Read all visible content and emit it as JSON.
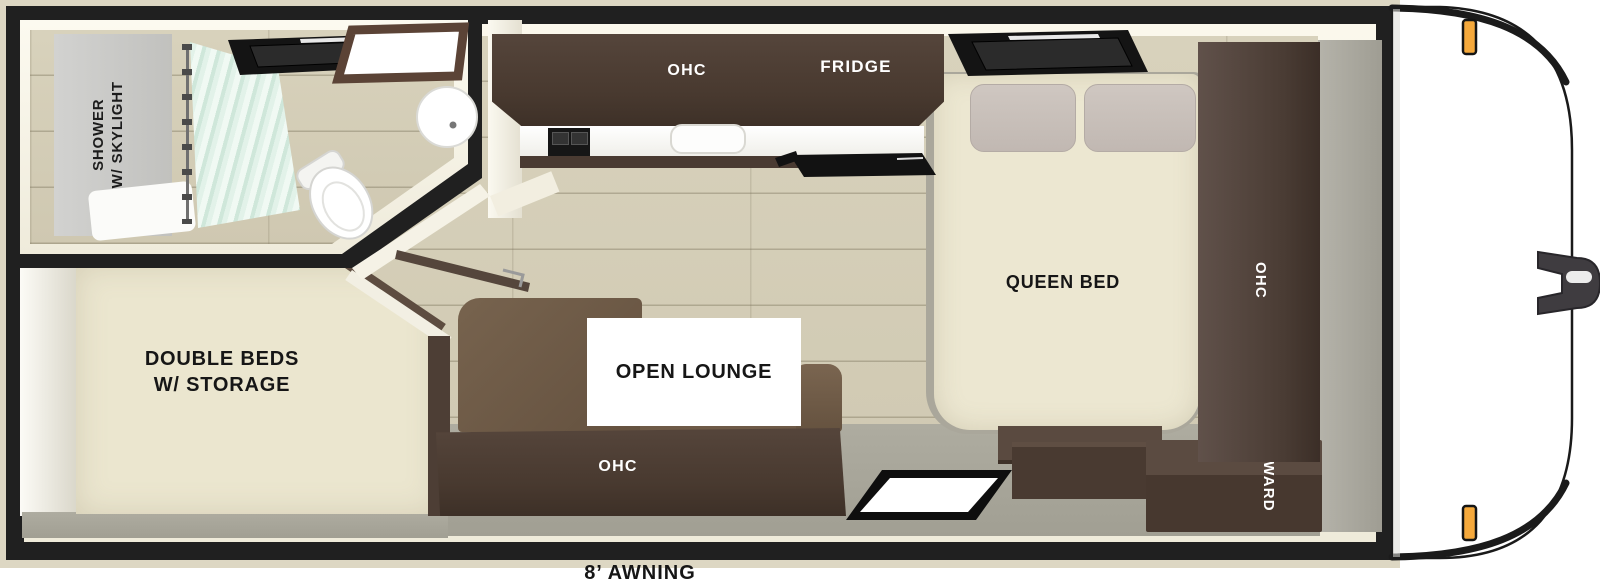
{
  "floorplan": {
    "awning_label": "8’ AWNING",
    "bathroom": {
      "label_line1": "SHOWER",
      "label_line2": "W/ SKYLIGHT"
    },
    "kitchen": {
      "ohc_label": "OHC",
      "fridge_label": "FRIDGE"
    },
    "bedroom": {
      "bed_label": "QUEEN BED",
      "ohc_label": "OHC",
      "ward_label": "WARD"
    },
    "double_beds": {
      "label_line1": "DOUBLE BEDS",
      "label_line2": "W/ STORAGE"
    },
    "lounge": {
      "label": "OPEN LOUNGE",
      "ohc_label": "OHC"
    },
    "colors": {
      "wall_black": "#202020",
      "outer_trim_beige": "#ddd7c3",
      "interior_trim_cream": "#f3efdf",
      "wood_floor": "#d3ccb5",
      "gray_floor": "#a7a59a",
      "cabinet_dark_brown": "#48392f",
      "sofa_brown": "#6e5a47",
      "bed_cream": "#ece7d1",
      "pillow_gray": "#c9c1bb",
      "curtain_mint": "#d9ece2",
      "marker_light_orange": "#f5a93c",
      "label_text_dark": "#161616",
      "label_text_light": "#ffffff"
    }
  }
}
